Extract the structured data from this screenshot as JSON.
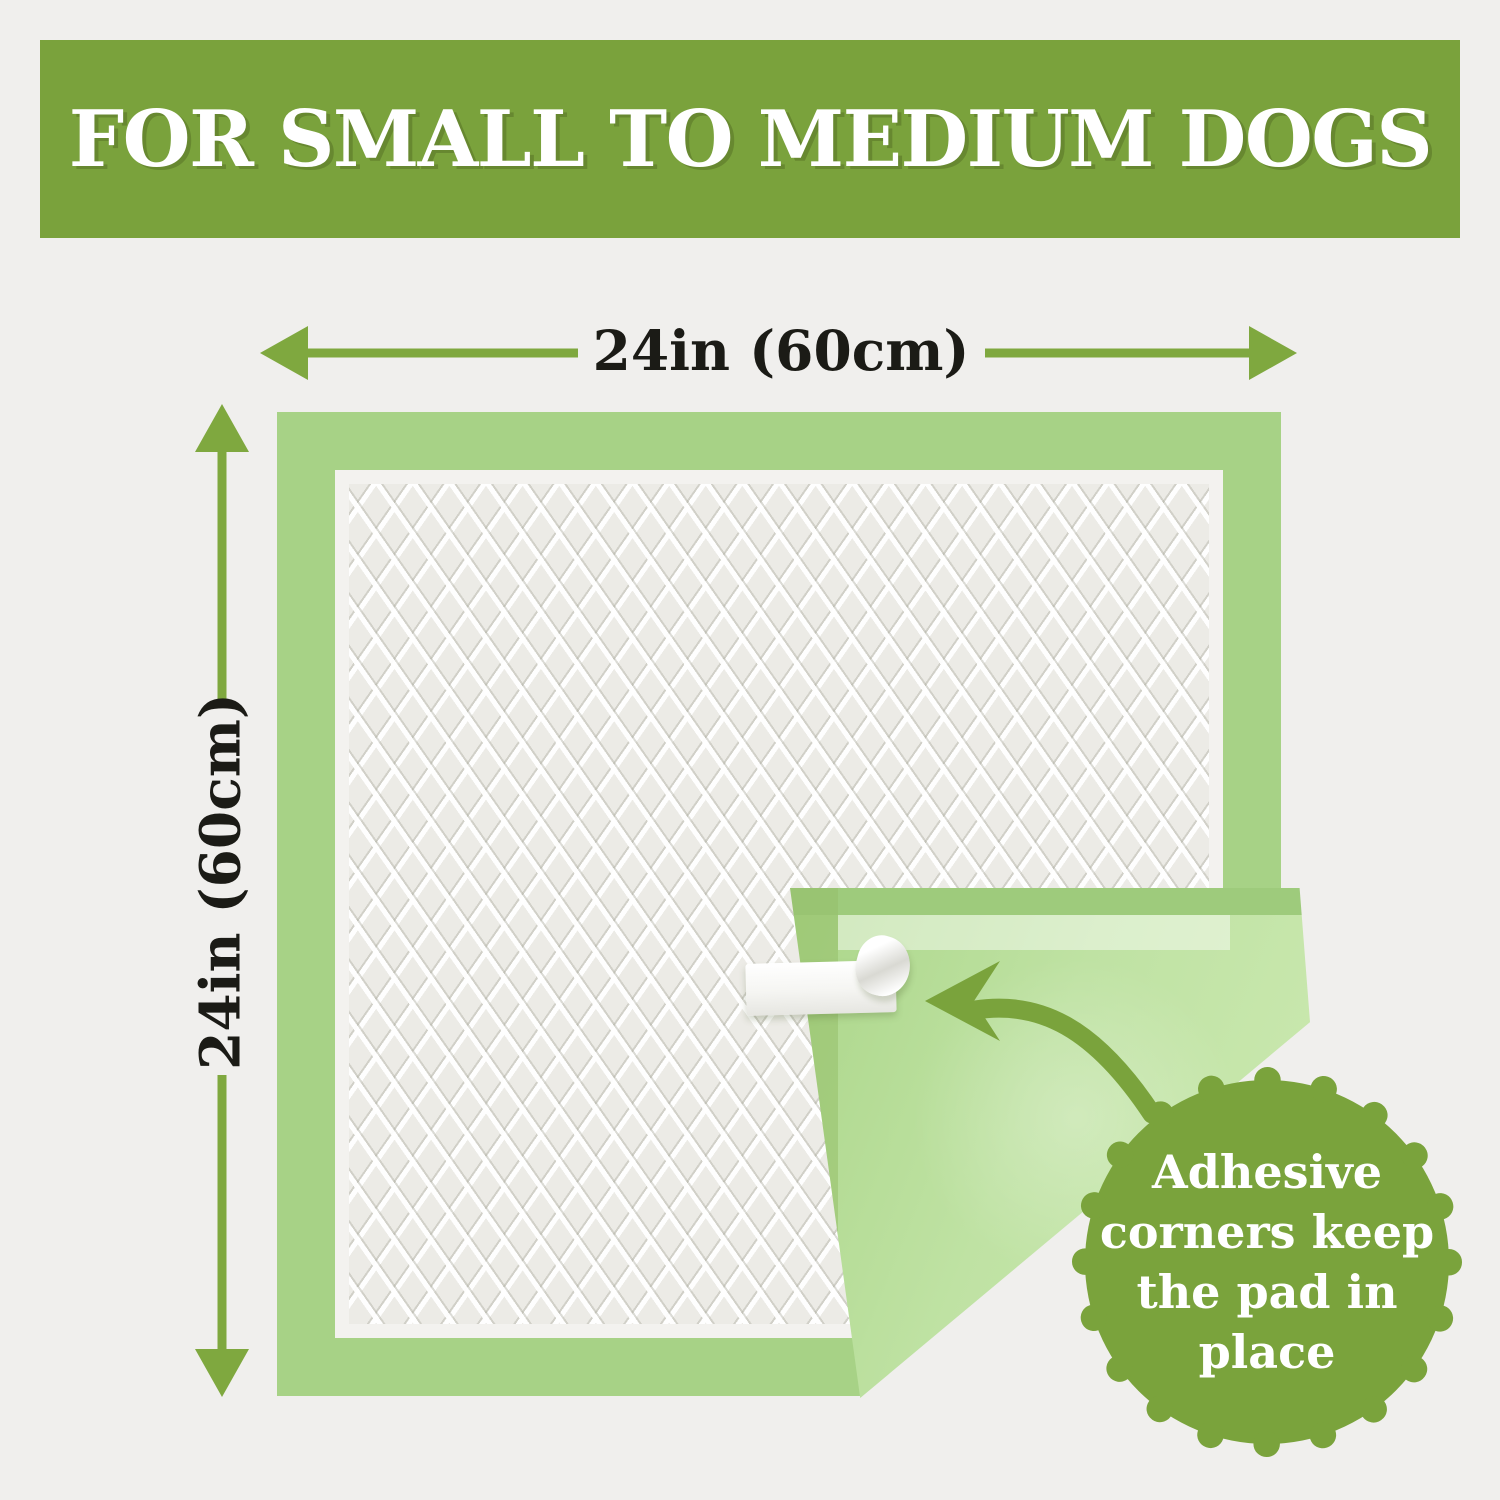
{
  "banner": {
    "text": "FOR SMALL TO MEDIUM DOGS"
  },
  "dimension_annotations": {
    "width_label": "24in (60cm)",
    "height_label": "24in (60cm)"
  },
  "badge": {
    "lines": [
      "Adhesive",
      "corners keep",
      "the pad in",
      "place"
    ]
  },
  "icons": {
    "width_arrow": "double-headed-horizontal-arrow",
    "height_arrow": "double-headed-vertical-arrow",
    "curved_arrow": "curved-arrow-pointing-to-tape",
    "badge_shape": "scalloped-seal",
    "tape": "adhesive-tape-peeling"
  },
  "colors": {
    "background": "#f0efed",
    "banner_green": "#7aa23c",
    "badge_green": "#7aa33c",
    "arrow_green": "#7fa83f",
    "pad_border_green": "#a7d286",
    "pad_back_green": "#bfe2a3",
    "quilt_white": "#ecebe6",
    "banner_text": "#ffffff",
    "badge_text": "#ffffff",
    "dimension_text": "#1b1b16",
    "tape_white": "#ffffff"
  }
}
